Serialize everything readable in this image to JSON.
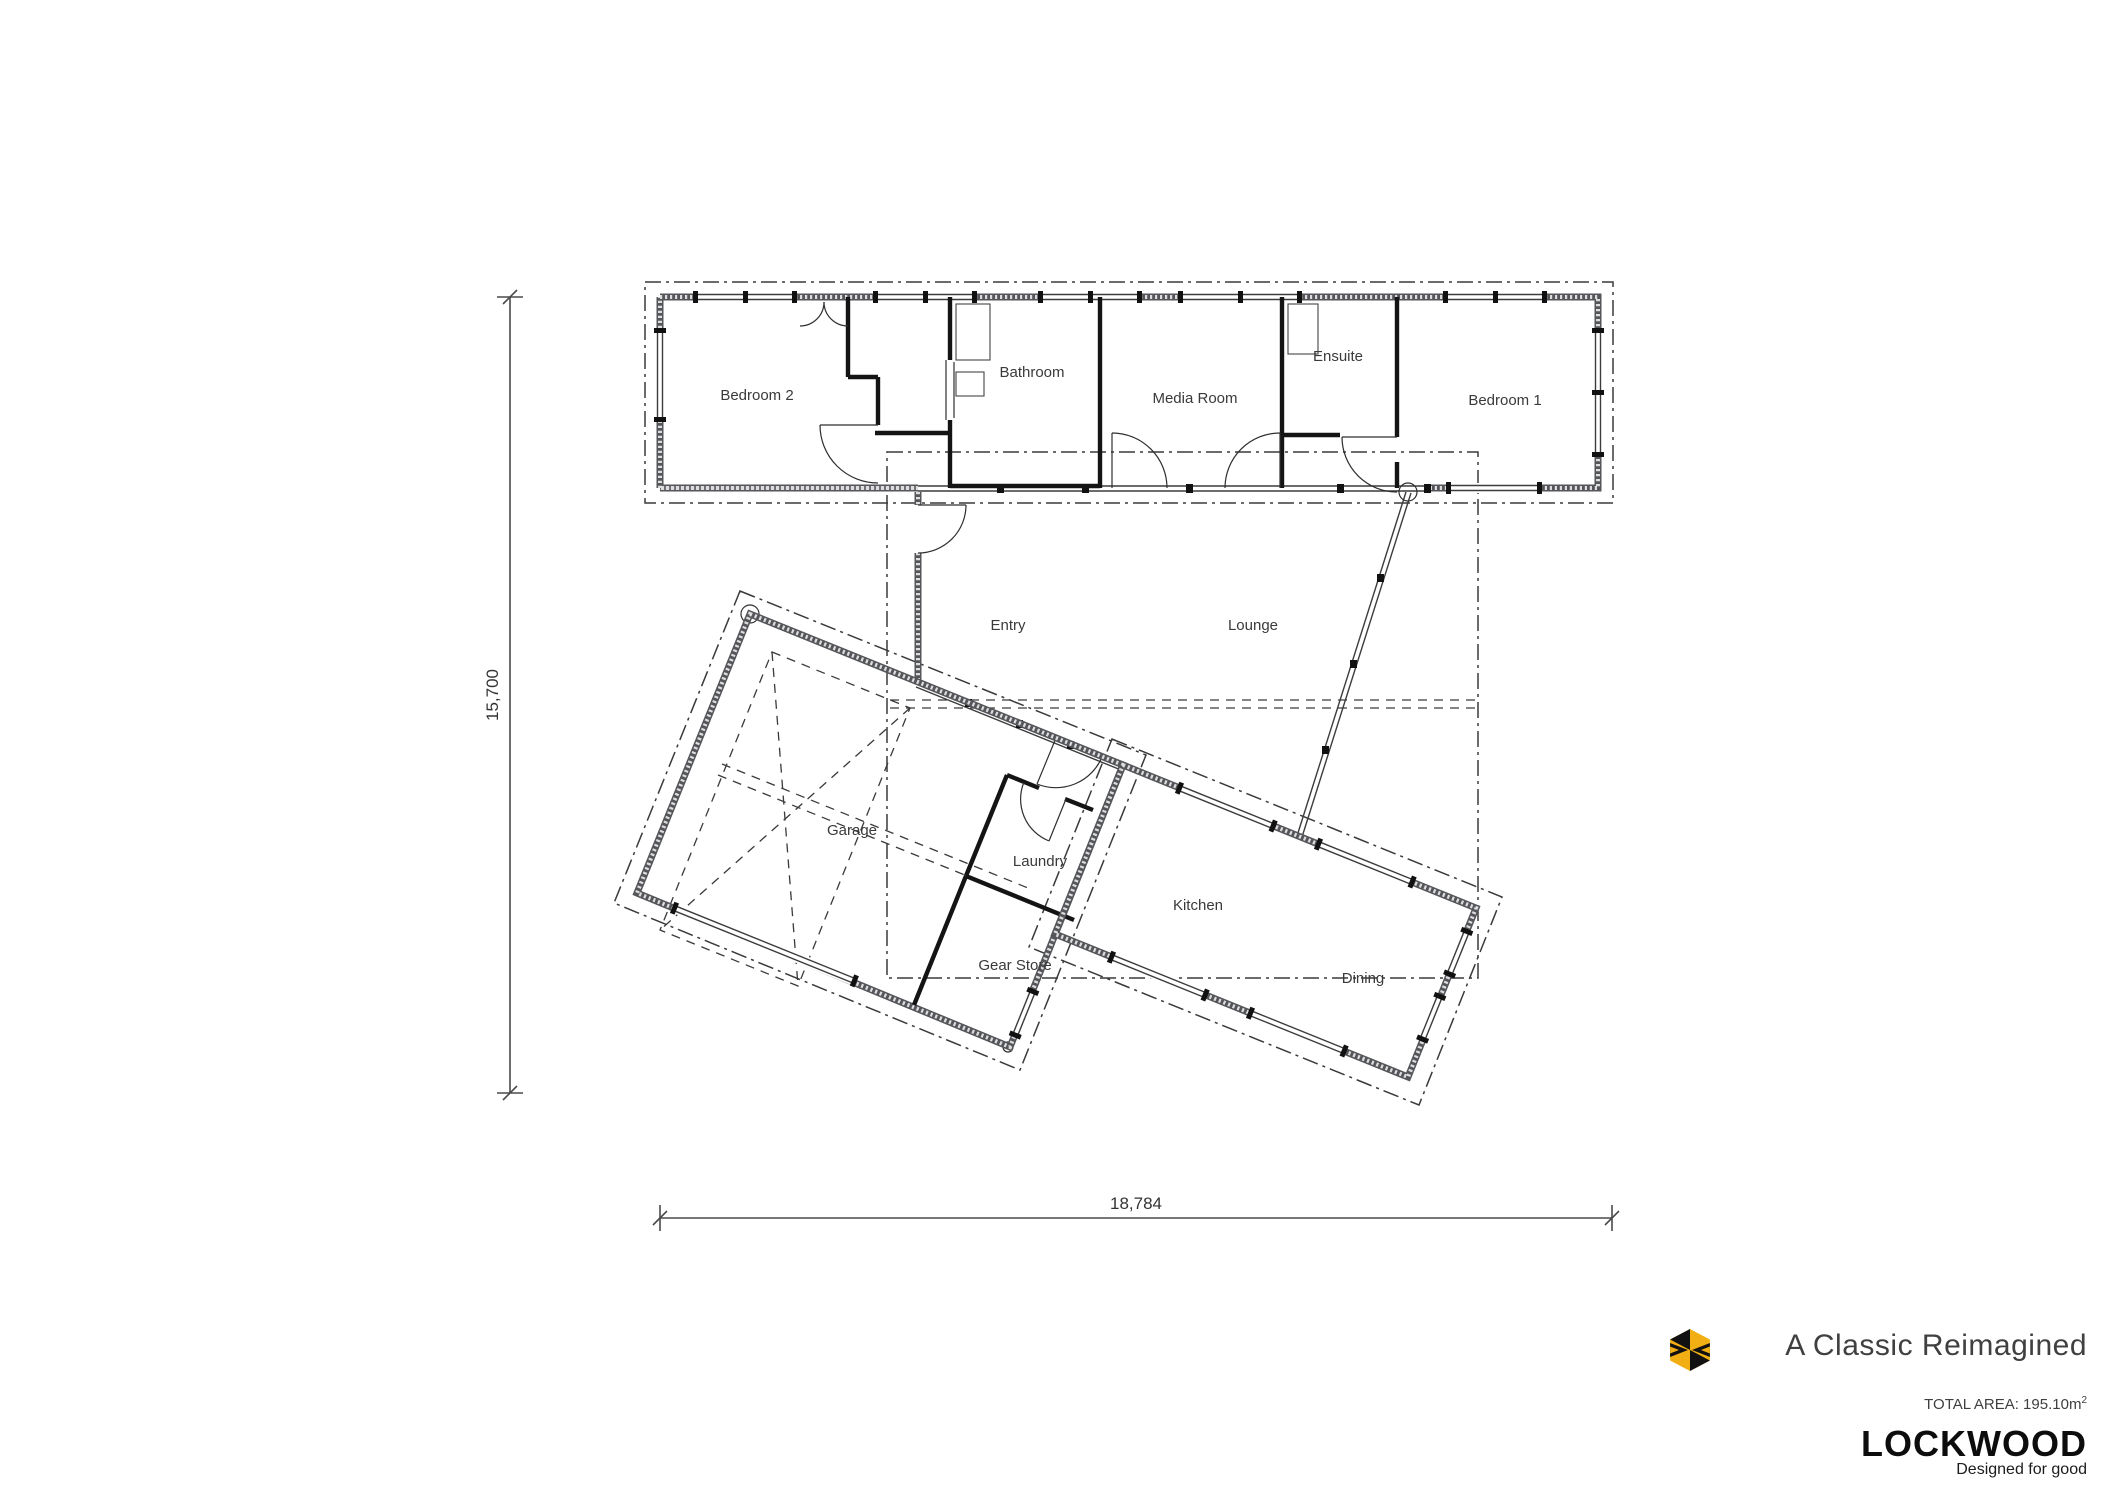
{
  "plan": {
    "rooms": {
      "bedroom2": "Bedroom 2",
      "bathroom": "Bathroom",
      "media": "Media Room",
      "ensuite": "Ensuite",
      "bedroom1": "Bedroom 1",
      "entry": "Entry",
      "lounge": "Lounge",
      "garage": "Garage",
      "laundry": "Laundry",
      "gear": "Gear Store",
      "kitchen": "Kitchen",
      "dining": "Dining"
    },
    "dimensions": {
      "height": "15,700",
      "width": "18,784"
    }
  },
  "title_block": {
    "title": "A Classic Reimagined",
    "total_area_label": "TOTAL AREA: 195.10m",
    "total_area_sup": "2",
    "brand": "LOCKWOOD",
    "tagline": "Designed for good",
    "brand_color": "#F2AF13",
    "icons": [
      "lockwood-hexagon-icon"
    ]
  }
}
